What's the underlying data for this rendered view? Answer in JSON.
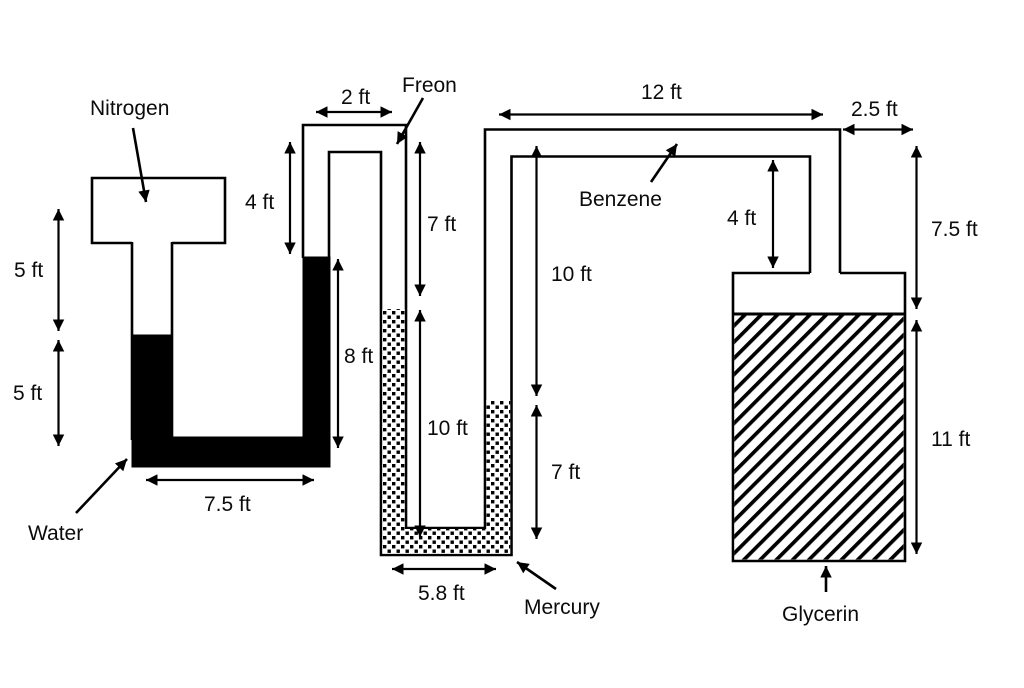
{
  "colors": {
    "ink": "#000000",
    "paper": "#ffffff"
  },
  "labels": {
    "nitrogen": "Nitrogen",
    "water": "Water",
    "freon": "Freon",
    "mercury": "Mercury",
    "benzene": "Benzene",
    "glycerin": "Glycerin"
  },
  "dims": {
    "nitrogen_column": "5 ft",
    "water_depth": "5 ft",
    "water_u_width": "7.5 ft",
    "water_right_column": "8 ft",
    "inverted_u_width": "2 ft",
    "riser_above_water": "4 ft",
    "freon_column": "7 ft",
    "mercury_left_column": "10 ft",
    "benzene_upper_column": "10 ft",
    "benzene_lower_column": "7 ft",
    "mercury_u_width": "5.8 ft",
    "benzene_pipe_run": "12 ft",
    "tank_offset": "2.5 ft",
    "tank_neck": "4 ft",
    "pipe_to_glycerin_surface": "7.5 ft",
    "glycerin_depth": "11 ft"
  }
}
